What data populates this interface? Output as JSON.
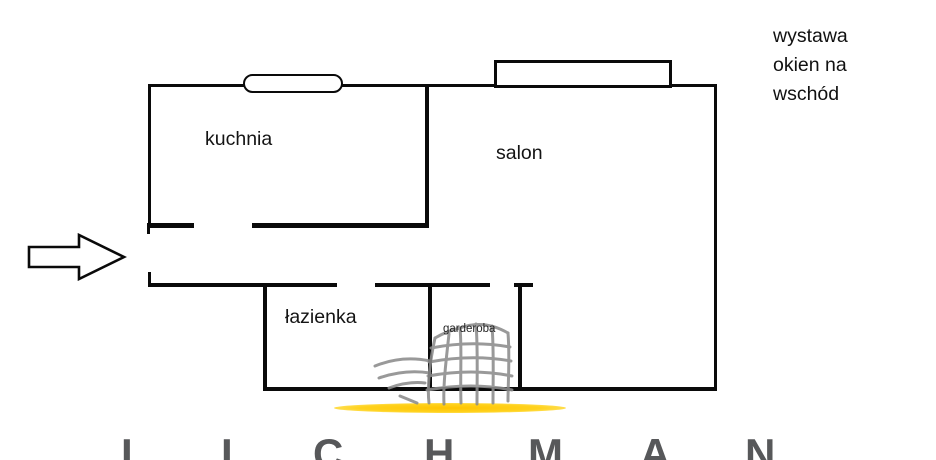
{
  "plan": {
    "rooms": {
      "kitchen": "kuchnia",
      "living_room": "salon",
      "bathroom": "łazienka",
      "wardrobe": "garderoba"
    },
    "note_lines": [
      "wystawa",
      "okien na",
      "wschód"
    ]
  },
  "watermark": {
    "letters": [
      "L",
      "I",
      "C",
      "H",
      "M",
      "A",
      "N"
    ]
  },
  "icons": {
    "entrance_arrow": "right-outline-arrow",
    "brand_logo": "sketched-highrise-building",
    "brand_swoosh": "yellow-lens-underline"
  },
  "colors": {
    "wall": "#0a0a0a",
    "text": "#141414",
    "brand_gray": "#8c8c8c",
    "letter_gray": "#57585a",
    "accent_yellow": "#ffc800"
  }
}
